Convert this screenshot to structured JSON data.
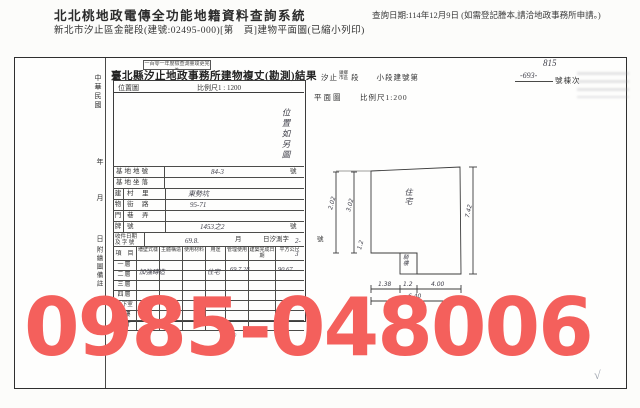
{
  "page": {
    "system_title": "北北桃地政電傳全功能地籍資料查詢系統",
    "query_date_note": "查詢日期:114年12月9日 (如需登記謄本,請洽地政事務所申請。)",
    "subtitle": "新北市汐止區金龍段(建號:02495-000)[第　頁]建物平面圖(已縮小列印)"
  },
  "doc": {
    "stamp_note": "一百零一年度檢查測量竣更完為",
    "title": "臺北縣汐止地政事務所建物複丈(勘測)結果",
    "margin": {
      "era": "中華民國",
      "year": "年",
      "month": "月",
      "day": "日",
      "note": "附繪圖備註"
    },
    "location": {
      "label": "位置圖",
      "scale": "比例尺1 : 1200",
      "note": "位置如另圖"
    },
    "fields": {
      "r1_label": "基地地號",
      "r1_value": "84-3",
      "r1_unit": "號",
      "r2_label": "基地坐落",
      "g1": "建",
      "g2": "物",
      "g3": "門",
      "g4": "牌",
      "r3_label": "村　里",
      "r3_value": "東勢坑",
      "r4_label": "街　路",
      "r4_value": "95-71",
      "r5_label": "巷　弄",
      "r6_label": "號",
      "r6_value": "1453之2",
      "r6_unit": "號"
    },
    "intake": {
      "label1": "收件日期",
      "label2": "及 字 號",
      "hw_date": "69.8.",
      "t_month": "月",
      "t_mid": "日汐測字",
      "hw_no": "2-3",
      "unit": "號"
    },
    "table": {
      "item_header": "項　目",
      "cols": [
        "墻壁式樣",
        "主體構造",
        "使用材料",
        "用途",
        "管理使用",
        "建築完成日期",
        "平方公尺"
      ],
      "rows": [
        "一層",
        "二層",
        "三層",
        "四層",
        "地下室",
        "騎樓",
        "合計"
      ],
      "hw": {
        "structure": "加強磚造",
        "use": "住宅",
        "date": "69.7.28",
        "area": "90.67",
        "faint": "6.10"
      }
    },
    "plan": {
      "line_city": "汐止",
      "line_opts1": "鎮鄉",
      "line_opts2": "市區",
      "line_mid": "段　　小段建號第",
      "line_suffix": "號棟次",
      "hw_top": "815",
      "hw_no": "-693-",
      "label": "平面圖",
      "scale": "比例尺1:200",
      "room": "住宅",
      "porch": "騎樓",
      "dims": {
        "left_outer": "2.02",
        "left_inner": "3.02",
        "right": "7.42",
        "b1": "1.38",
        "b2": "1.2",
        "b3": "4.00",
        "total": "6.40",
        "small": "1.2"
      }
    }
  },
  "watermark": {
    "text": "0985-048006",
    "color": "#f4605c"
  },
  "footer_check": "√"
}
